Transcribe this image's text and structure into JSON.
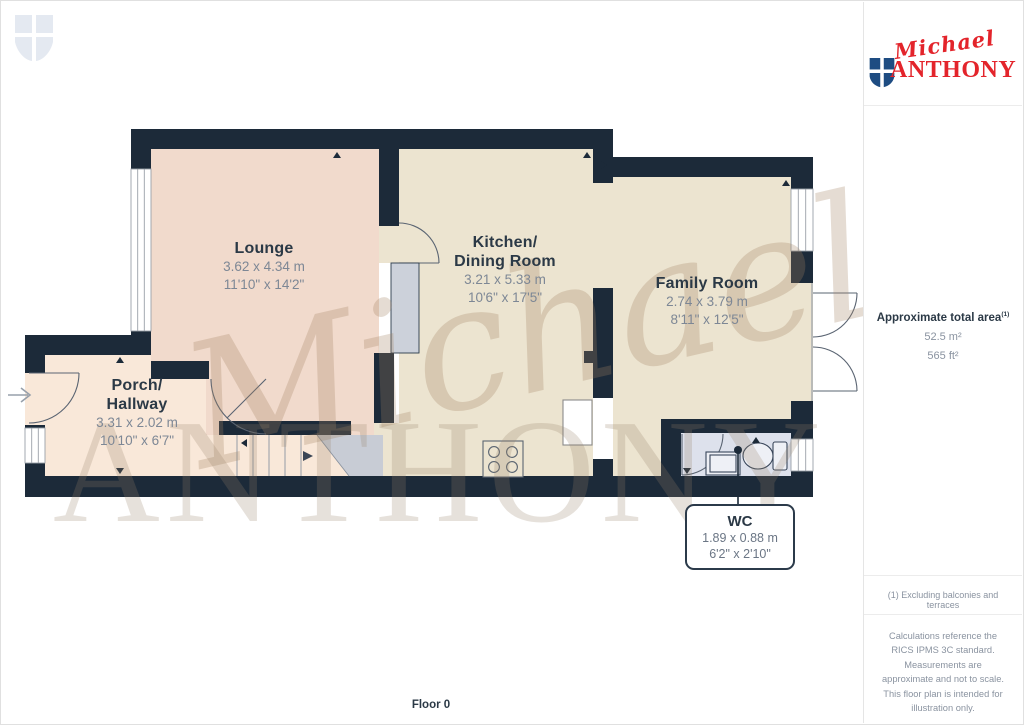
{
  "page": {
    "floor_label": "Floor 0"
  },
  "watermark": {
    "script": "Michael",
    "serif": "ANTHONY"
  },
  "logo": {
    "script": "Michael",
    "name": "ANTHONY"
  },
  "sidebar": {
    "area_title": "Approximate total area",
    "area_note_ref": "(1)",
    "area_metric": "52.5 m²",
    "area_imperial": "565 ft²",
    "footnote": "(1) Excluding balconies and terraces",
    "disclaimer": "Calculations reference the RICS IPMS 3C standard. Measurements are approximate and not to scale. This floor plan is intended for illustration only.",
    "credit_brand": "GIRAFFE",
    "credit_suffix": "360"
  },
  "rooms": {
    "lounge": {
      "name": "Lounge",
      "metric": "3.62 x 4.34 m",
      "imperial": "11'10\" x 14'2\""
    },
    "kitchen": {
      "name_line1": "Kitchen/",
      "name_line2": "Dining Room",
      "metric": "3.21 x 5.33 m",
      "imperial": "10'6\" x 17'5\""
    },
    "family": {
      "name": "Family Room",
      "metric": "2.74 x 3.79 m",
      "imperial": "8'11\" x 12'5\""
    },
    "porch": {
      "name_line1": "Porch/",
      "name_line2": "Hallway",
      "metric": "3.31 x 2.02 m",
      "imperial": "10'10\" x 6'7\""
    },
    "wc": {
      "name": "WC",
      "metric": "1.89 x 0.88 m",
      "imperial": "6'2\" x 2'10\""
    }
  },
  "colors": {
    "wall": "#1c2a39",
    "lounge_fill": "#f1dacc",
    "kitchen_fill": "#ece4d0",
    "porch_fill": "#f9e8d9",
    "wc_fill": "#dde1ec",
    "landing_gray": "#c8ccd5",
    "brand_red": "#e3242b",
    "brand_blue": "#1e4c82"
  }
}
